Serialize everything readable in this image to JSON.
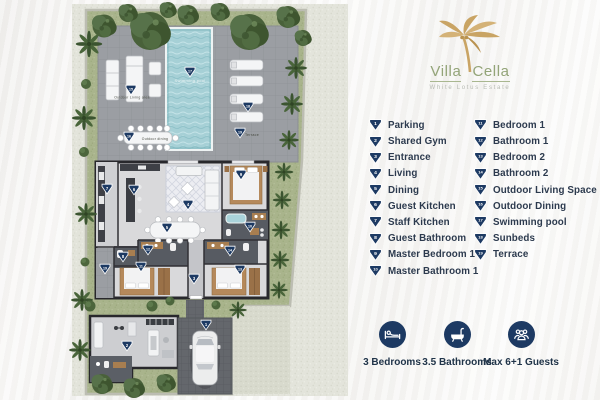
{
  "brand": {
    "word1": "Villa",
    "word2": "Cella",
    "tagline": "White Lotus Estate"
  },
  "colors": {
    "marker_navy": "#1d3a63",
    "logo_gold": "#c9a464",
    "logo_green": "#93a478",
    "legend_text": "#2c3a4e"
  },
  "legend": {
    "columns": [
      [
        {
          "n": 1,
          "label": "Parking"
        },
        {
          "n": 2,
          "label": "Shared Gym"
        },
        {
          "n": 3,
          "label": "Entrance"
        },
        {
          "n": 4,
          "label": "Living"
        },
        {
          "n": 5,
          "label": "Dining"
        },
        {
          "n": 6,
          "label": "Guest Kitchen"
        },
        {
          "n": 7,
          "label": "Staff Kitchen"
        },
        {
          "n": 8,
          "label": "Guest Bathroom"
        },
        {
          "n": 9,
          "label": "Master Bedroom 1"
        },
        {
          "n": 10,
          "label": "Master Bathroom 1"
        }
      ],
      [
        {
          "n": 11,
          "label": "Bedroom 1"
        },
        {
          "n": 12,
          "label": "Bathroom 1"
        },
        {
          "n": 13,
          "label": "Bedroom 2"
        },
        {
          "n": 14,
          "label": "Bathroom 2"
        },
        {
          "n": 15,
          "label": "Outdoor Living Space"
        },
        {
          "n": 16,
          "label": "Outdoor Dining"
        },
        {
          "n": 17,
          "label": "Swimming pool"
        },
        {
          "n": 18,
          "label": "Sunbeds"
        },
        {
          "n": 19,
          "label": "Terrace"
        }
      ]
    ]
  },
  "stats": {
    "items": [
      {
        "icon": "bed-icon",
        "label": "3 Bedrooms"
      },
      {
        "icon": "bathtub-icon",
        "label": "3.5 Bathrooms"
      },
      {
        "icon": "guests-icon",
        "label": "Max 6+1 Guests"
      }
    ]
  },
  "floorplan": {
    "markers": [
      {
        "n": 1,
        "x": 206,
        "y": 325
      },
      {
        "n": 2,
        "x": 127,
        "y": 346
      },
      {
        "n": 3,
        "x": 194,
        "y": 279
      },
      {
        "n": 4,
        "x": 188,
        "y": 205
      },
      {
        "n": 5,
        "x": 167,
        "y": 228
      },
      {
        "n": 6,
        "x": 134,
        "y": 190
      },
      {
        "n": 7,
        "x": 107,
        "y": 189
      },
      {
        "n": 8,
        "x": 123,
        "y": 257
      },
      {
        "n": 9,
        "x": 241,
        "y": 175
      },
      {
        "n": 10,
        "x": 250,
        "y": 227
      },
      {
        "n": 11,
        "x": 141,
        "y": 267
      },
      {
        "n": 12,
        "x": 148,
        "y": 250
      },
      {
        "n": 13,
        "x": 240,
        "y": 270
      },
      {
        "n": 14,
        "x": 230,
        "y": 251
      },
      {
        "n": 15,
        "x": 131,
        "y": 90
      },
      {
        "n": 16,
        "x": 129,
        "y": 137
      },
      {
        "n": 17,
        "x": 190,
        "y": 72
      },
      {
        "n": 18,
        "x": 248,
        "y": 107
      },
      {
        "n": 19,
        "x": 240,
        "y": 133
      },
      {
        "n": 19,
        "x": 105,
        "y": 269
      }
    ],
    "labels": [
      {
        "text": "Swimming pool",
        "x": 190,
        "y": 82,
        "tone": "light",
        "size": 4
      },
      {
        "text": "Outdoor Living area",
        "x": 132,
        "y": 98.5,
        "tone": "dark",
        "size": 3.4
      },
      {
        "text": "Outdoor dining",
        "x": 155,
        "y": 140,
        "tone": "dark",
        "size": 3.4
      },
      {
        "text": "Terrace",
        "x": 252,
        "y": 136,
        "tone": "dark",
        "size": 3.6
      }
    ]
  }
}
